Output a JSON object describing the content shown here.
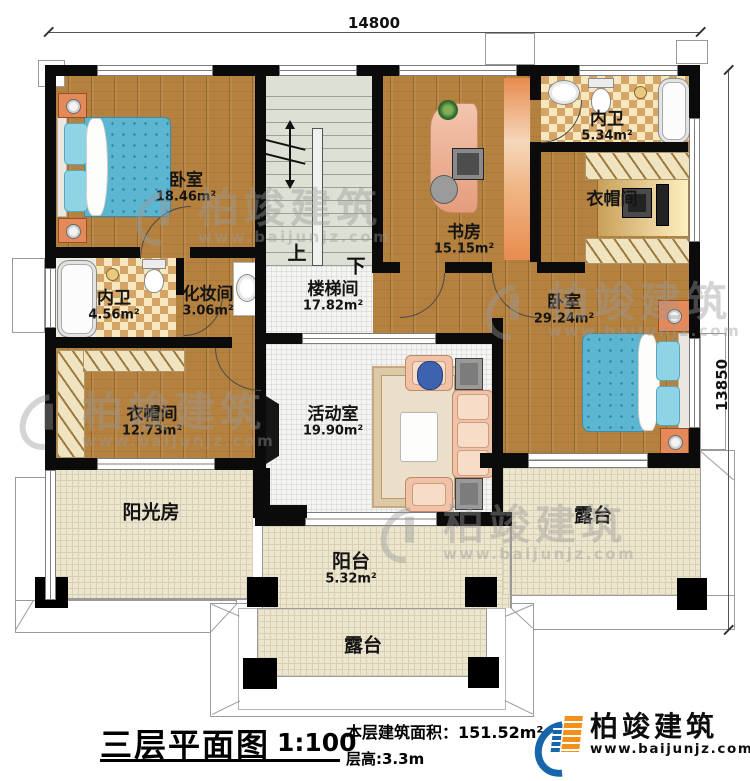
{
  "dimensions": {
    "top": "14800",
    "right": "13850"
  },
  "stairs": {
    "up": "上",
    "down": "下"
  },
  "rooms": [
    {
      "id": "bedroom-tl",
      "name": "卧室",
      "area": "18.46m²"
    },
    {
      "id": "stairwell",
      "name": "楼梯间",
      "area": "17.82m²"
    },
    {
      "id": "study",
      "name": "书房",
      "area": "15.15m²"
    },
    {
      "id": "bath-tr",
      "name": "内卫",
      "area": "5.34m²"
    },
    {
      "id": "cloakroom-r",
      "name": "衣帽间",
      "area": ""
    },
    {
      "id": "bath-ml",
      "name": "内卫",
      "area": "4.56m²"
    },
    {
      "id": "makeup",
      "name": "化妆间",
      "area": "3.06m²"
    },
    {
      "id": "cloakroom-l",
      "name": "衣帽间",
      "area": "12.73m²"
    },
    {
      "id": "activity",
      "name": "活动室",
      "area": "19.90m²"
    },
    {
      "id": "bedroom-r",
      "name": "卧室",
      "area": "29.24m²"
    },
    {
      "id": "sunroom",
      "name": "阳光房",
      "area": ""
    },
    {
      "id": "balcony",
      "name": "阳台",
      "area": "5.32m²"
    },
    {
      "id": "terrace-r",
      "name": "露台",
      "area": ""
    },
    {
      "id": "terrace-b",
      "name": "露台",
      "area": ""
    }
  ],
  "title": {
    "main": "三层平面图",
    "scale": "1:100",
    "area_label": "本层建筑面积：",
    "area_value": "151.52m²",
    "floor_height": "层高:3.3m"
  },
  "brand": {
    "name": "柏竣建筑",
    "url": "www.baijunjz.com"
  },
  "watermark": {
    "name": "柏竣建筑",
    "url": "www.baijunjz.com"
  }
}
